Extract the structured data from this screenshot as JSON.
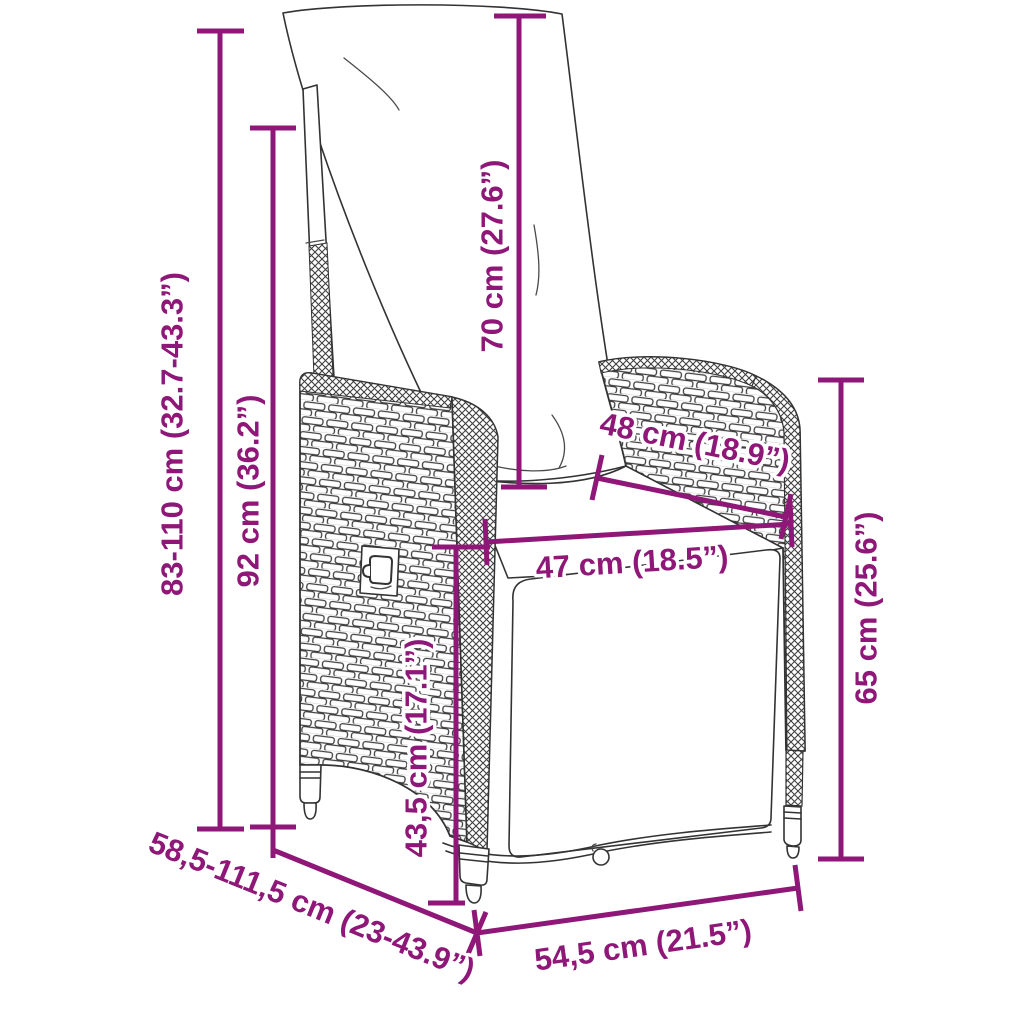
{
  "diagram": {
    "type": "product-dimension-diagram",
    "subject": "reclining rattan garden chair with cushions",
    "background_color": "#FFFFFF",
    "accent_color": "#8E1778",
    "line_art_color": "#333333",
    "icons": {
      "knob_icon": "lock-shaped recline adjustment knob"
    },
    "dimensions": [
      {
        "id": "total-height",
        "label": "83-110 cm (32.7-43.3”)",
        "orientation": "vertical"
      },
      {
        "id": "backrest-height",
        "label": "92 cm (36.2”)",
        "orientation": "vertical"
      },
      {
        "id": "back-cushion-height",
        "label": "70 cm (27.6”)",
        "orientation": "vertical"
      },
      {
        "id": "armrest-length",
        "label": "48 cm (18.9”)",
        "orientation": "diagonal"
      },
      {
        "id": "seat-width",
        "label": "47 cm (18.5”)",
        "orientation": "diagonal"
      },
      {
        "id": "armrest-height",
        "label": "65 cm (25.6”)",
        "orientation": "vertical"
      },
      {
        "id": "seat-height",
        "label": "43,5 cm (17.1”)",
        "orientation": "vertical"
      },
      {
        "id": "depth-range",
        "label": "58,5-111,5 cm (23-43.9”)",
        "orientation": "diagonal"
      },
      {
        "id": "base-width",
        "label": "54,5 cm (21.5”)",
        "orientation": "diagonal"
      }
    ]
  }
}
